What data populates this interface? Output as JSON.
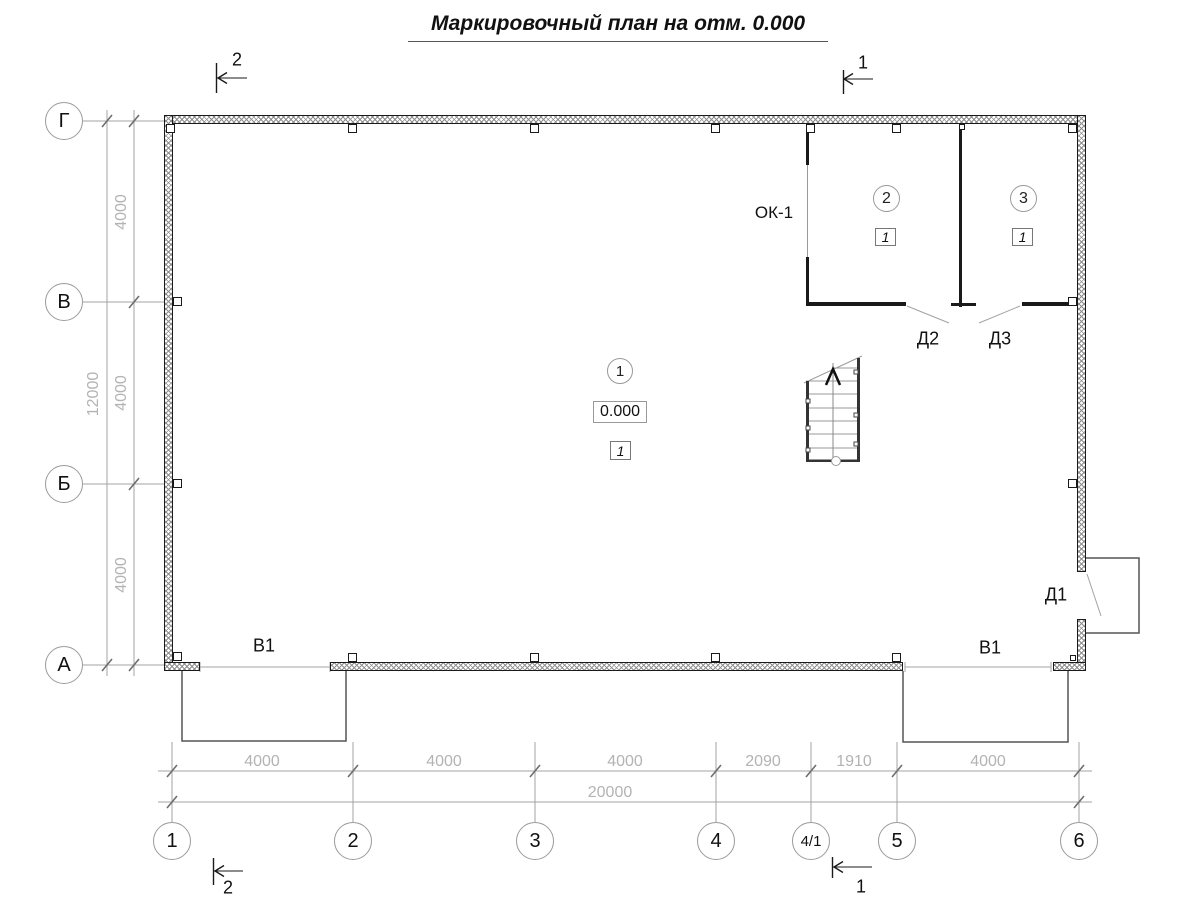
{
  "title": "Маркировочный план на отм. 0.000",
  "axes": {
    "vertical": [
      "Г",
      "В",
      "Б",
      "А"
    ],
    "horizontal": [
      "1",
      "2",
      "3",
      "4",
      "4/1",
      "5",
      "6"
    ]
  },
  "dimensions": {
    "left_segments": [
      "4000",
      "4000",
      "4000"
    ],
    "left_total": "12000",
    "bottom_segments": [
      "4000",
      "4000",
      "4000",
      "2090",
      "1910",
      "4000"
    ],
    "bottom_total": "20000"
  },
  "section_marks": {
    "top_left": "2",
    "top_right": "1",
    "bottom_left": "2",
    "bottom_right": "1"
  },
  "rooms": {
    "hall": {
      "number": "1",
      "elevation": "0.000",
      "finish_type": "1"
    },
    "room2": {
      "number": "2",
      "finish_type": "1"
    },
    "room3": {
      "number": "3",
      "finish_type": "1"
    }
  },
  "openings": {
    "window_label": "ОК-1",
    "door_d1": "Д1",
    "door_d2": "Д2",
    "door_d3": "Д3",
    "gate_left": "В1",
    "gate_right": "В1"
  }
}
